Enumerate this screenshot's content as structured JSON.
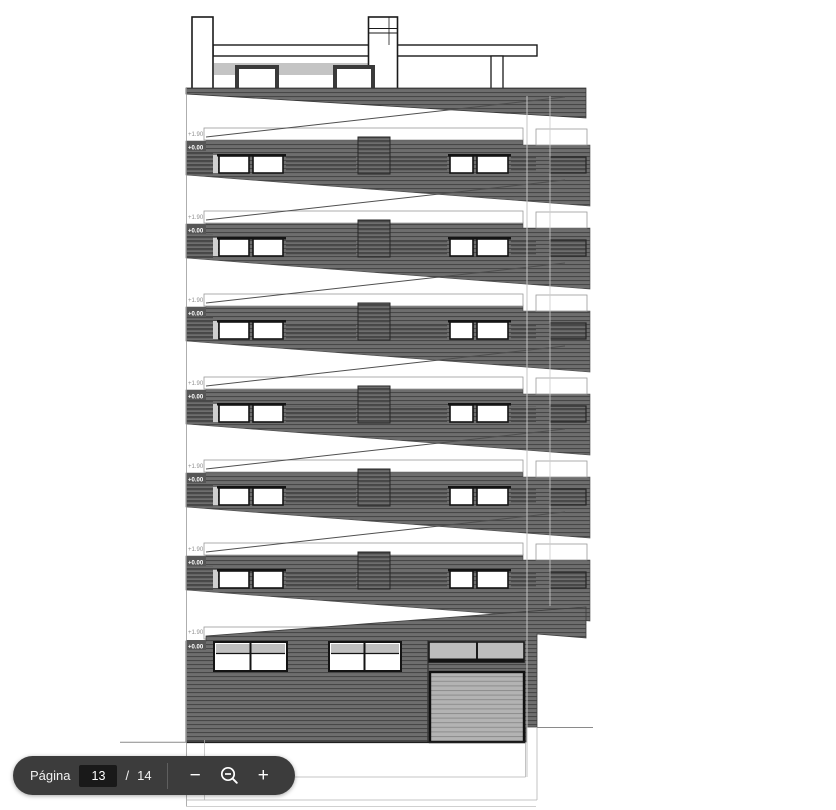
{
  "viewer": {
    "background": "#ffffff"
  },
  "toolbar": {
    "background": "#3c3c3c",
    "page_label": "Página",
    "current_page": "13",
    "page_separator": "/",
    "total_pages": "14",
    "zoom_out_label": "−",
    "zoom_in_label": "+",
    "zoom_tool_icon": "magnifier-minus-icon"
  },
  "drawing": {
    "type": "architectural-elevation",
    "upper_floor_count": 6,
    "has_ground_floor": true,
    "levels": {
      "upper": "+1.90",
      "lower": "+0.00"
    },
    "colors": {
      "facade": "#6e6e6e",
      "facade_stripe": "#474747",
      "terrace_band": "#c4c4c4",
      "garage_door": "#b3b3b3",
      "garage_door_stripe": "#8d8d8d",
      "window_transom": "#c0c0c0",
      "outline": "#1a1a1a"
    }
  }
}
